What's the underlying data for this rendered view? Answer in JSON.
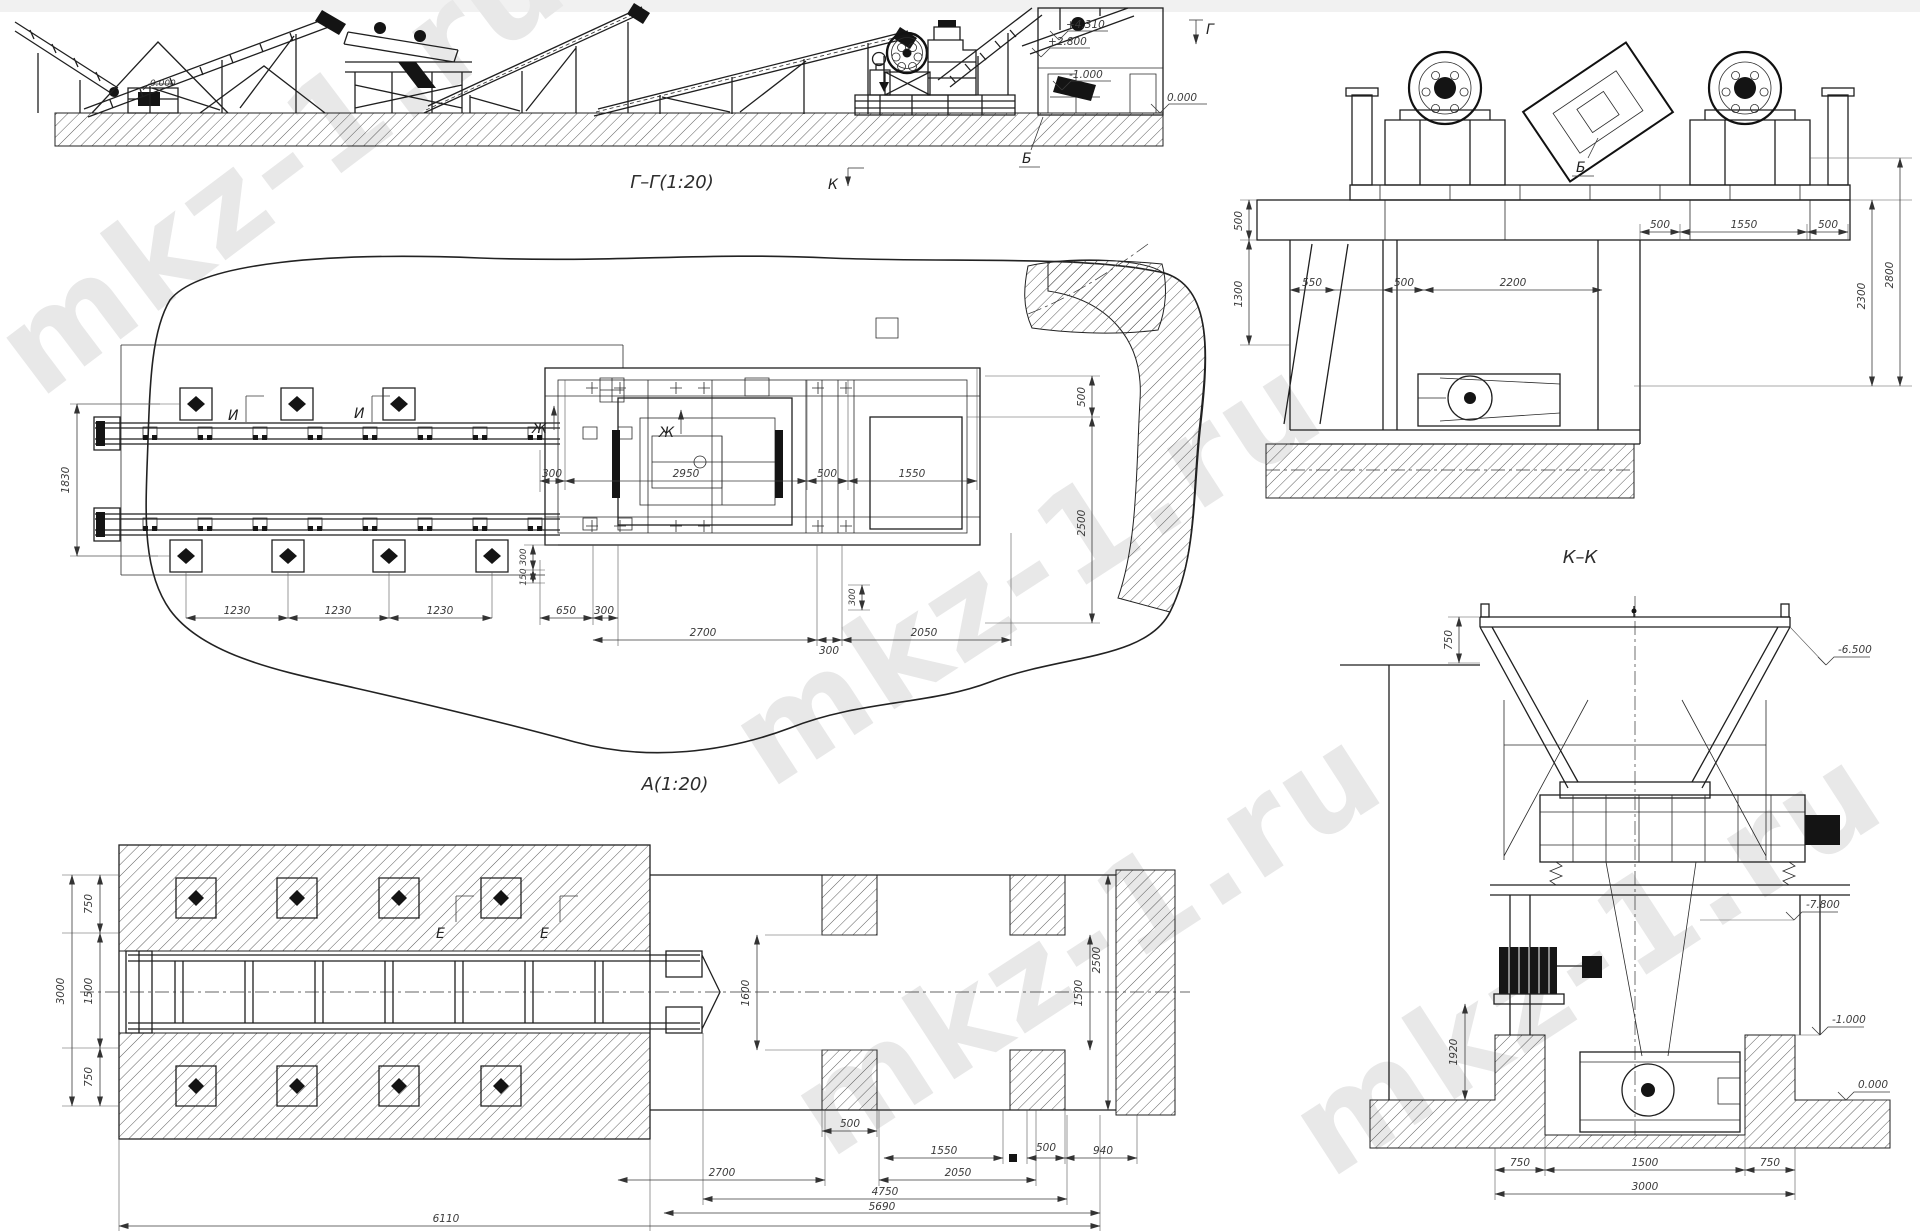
{
  "watermark": {
    "text": "mkz-1.ru",
    "color": "#e8e8e8"
  },
  "elevation_gg": {
    "title": "Г–Г(1:20)",
    "section_mark_k": "К",
    "section_mark_g": "Г",
    "leader_b": "Б",
    "ground_level_small": "0.000",
    "elevations": [
      "+4.310",
      "+2.800",
      "-1.000",
      "0.000"
    ]
  },
  "plan_a": {
    "title": "А(1:20)",
    "mark_i": "И",
    "mark_zh": "Ж",
    "dim_rows_gap": "1830",
    "dims_mid": [
      "300",
      "2950",
      "500",
      "1550"
    ],
    "dims_bottom": [
      "1230",
      "1230",
      "1230",
      "650",
      "300"
    ],
    "dims_bottom2": [
      "2700",
      "300",
      "2050"
    ],
    "dims_small_left": [
      "300",
      "150"
    ],
    "dim_small_right": "300",
    "dims_right": [
      "500",
      "2500"
    ]
  },
  "section_kk": {
    "title": "К–К",
    "leader_b": "Б",
    "dims_left": [
      "500",
      "1300"
    ],
    "dims_pit": [
      "550",
      "500",
      "2200"
    ],
    "dims_top": [
      "500",
      "1550",
      "500"
    ],
    "dims_right": [
      "2300",
      "2800"
    ]
  },
  "plan_bottom": {
    "mark_e": "Е",
    "dims_left": [
      "750",
      "1500",
      "750",
      "3000"
    ],
    "dim_width": "1600",
    "dims_right": [
      "1500",
      "2500"
    ],
    "dim_t1": "500",
    "dims_t2": [
      "1550",
      "500",
      "940"
    ],
    "dims_t3": [
      "2700",
      "2050"
    ],
    "dim_t4": "4750",
    "dim_t5": "5690",
    "dim_t6": "6110"
  },
  "front_view": {
    "dim_rim": "750",
    "dim_pit": "1920",
    "elevations": [
      "-6.500",
      "-7.800",
      "-1.000",
      "0.000"
    ],
    "dims_bottom": [
      "750",
      "1500",
      "750"
    ],
    "dim_total": "3000"
  }
}
